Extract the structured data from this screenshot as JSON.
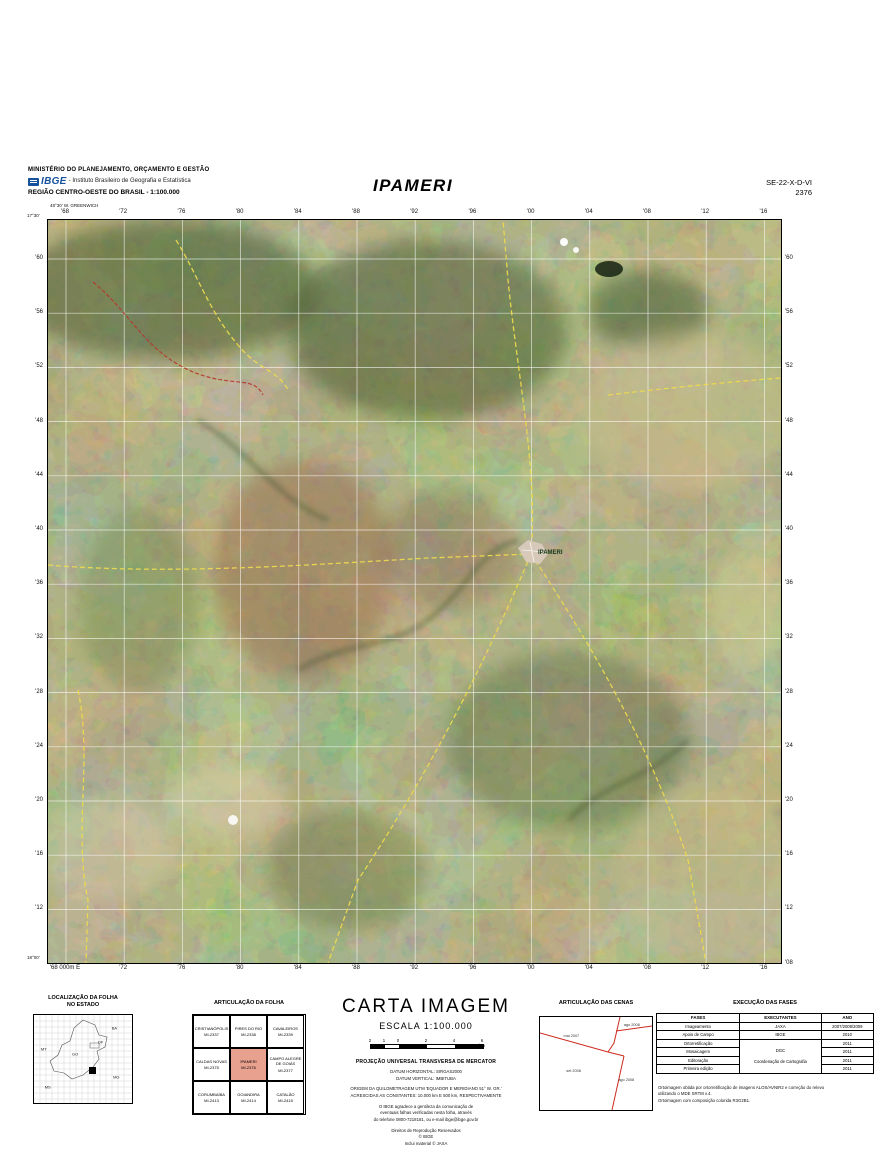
{
  "header": {
    "ministry": "MINISTÉRIO DO PLANEJAMENTO, ORÇAMENTO E GESTÃO",
    "ibge_acronym": "IBGE",
    "ibge_institute": "- Instituto Brasileiro de Geografia e Estatística",
    "region": "REGIÃO CENTRO-OESTE DO BRASIL - 1:100.000",
    "title": "IPAMERI",
    "sheet_code": "SE-22-X-D-VI",
    "sheet_number": "2376"
  },
  "map": {
    "city_label": "IPAMERI",
    "top_labels": [
      "'68",
      "'72",
      "'76",
      "'80",
      "'84",
      "'88",
      "'92",
      "'96",
      "'00",
      "'04",
      "'08",
      "'12",
      "'16"
    ],
    "bottom_labels": [
      "'68 000m E",
      "'72",
      "'76",
      "'80",
      "'84",
      "'88",
      "'92",
      "'96",
      "'00",
      "'04",
      "'08",
      "'12",
      "'16"
    ],
    "left_labels": [
      "'60",
      "'56",
      "'52",
      "'48",
      "'44",
      "'40",
      "'36",
      "'32",
      "'28",
      "'24",
      "'20",
      "'16",
      "'12"
    ],
    "right_labels": [
      "'60",
      "'56",
      "'52",
      "'48",
      "'44",
      "'40",
      "'36",
      "'32",
      "'28",
      "'24",
      "'20",
      "'16",
      "'12",
      "'08"
    ],
    "corners": [
      {
        "text": "48°30' W. GREENWICH",
        "x": 50,
        "y": 203
      },
      {
        "text": "17°30'",
        "x": 27,
        "y": 213
      },
      {
        "text": "18°00'",
        "x": 27,
        "y": 955
      }
    ]
  },
  "localizacao": {
    "title_1": "LOCALIZAÇÃO DA FOLHA",
    "title_2": "NO ESTADO",
    "labels": [
      {
        "t": "MT",
        "x": 10,
        "y": 38
      },
      {
        "t": "BA",
        "x": 82,
        "y": 14
      },
      {
        "t": "GO",
        "x": 42,
        "y": 44
      },
      {
        "t": "DF",
        "x": 68,
        "y": 30
      },
      {
        "t": "MG",
        "x": 84,
        "y": 70
      },
      {
        "t": "MS",
        "x": 14,
        "y": 82
      }
    ]
  },
  "articulacao_folha": {
    "title": "ARTICULAÇÃO DA FOLHA",
    "cells": [
      {
        "name": "CRISTIANÓPOLIS",
        "code": "MI-2337"
      },
      {
        "name": "PIRES DO RIO",
        "code": "MI-2338"
      },
      {
        "name": "CAVALEIROS",
        "code": "MI-2339"
      },
      {
        "name": "CALDAS NOVAS",
        "code": "MI-2375"
      },
      {
        "name": "IPAMERI",
        "code": "MI-2376",
        "highlight": true
      },
      {
        "name": "CAMPO ALEGRE DE GOIÁS",
        "code": "MI-2377"
      },
      {
        "name": "CORUMBAÍBA",
        "code": "MI-2413"
      },
      {
        "name": "GOIANDIRA",
        "code": "MI-2414"
      },
      {
        "name": "CATALÃO",
        "code": "MI-2415"
      }
    ]
  },
  "carta": {
    "title": "CARTA IMAGEM",
    "escala": "ESCALA 1:100.000",
    "scale_ticks": [
      "2",
      "1",
      "0",
      "2",
      "4",
      "6"
    ],
    "scale_unit": "km",
    "projecao": "PROJEÇÃO UNIVERSAL TRANSVERSA DE MERCATOR",
    "datum_lines": [
      "DATUM HORIZONTAL: SIRGAS2000",
      "DATUM VERTICAL: IMBITUBA"
    ],
    "origem_lines": [
      "ORIGEM DA QUILOMETRAGEM UTM 'EQUADOR E MERIDIANO 51° W. GR.'",
      "ACRESCIDAS AS CONSTANTES: 10.000 km E 500 km, RESPECTIVAMENTE"
    ],
    "aviso_lines": [
      "O IBGE agradece a gentileza da comunicação de",
      "eventuais falhas verificadas nesta folha, através",
      "do telefone 0800-7218181, ou e-mail ibge@ibge.gov.br"
    ],
    "direitos_lines": [
      "Direitos de Reprodução Reservados",
      "© IBGE",
      "Inclui material © JAXA"
    ]
  },
  "cenas": {
    "title": "ARTICULAÇÃO DAS CENAS",
    "labels": [
      {
        "text": "mai 2007",
        "x": 28,
        "y": 20
      },
      {
        "text": "ago 2008",
        "x": 82,
        "y": 8
      },
      {
        "text": "set 2008",
        "x": 30,
        "y": 58
      },
      {
        "text": "ago 2008",
        "x": 77,
        "y": 68
      }
    ]
  },
  "fases": {
    "title": "EXECUÇÃO DAS FASES",
    "headers": [
      "FASES",
      "EXECUTANTES",
      "ANO"
    ],
    "rows": [
      {
        "fase": "Imageamento",
        "exec": "JAXA",
        "ano": "2007/2008/2009"
      },
      {
        "fase": "Apoio de Campo",
        "exec": "IBGE",
        "ano": "2010"
      },
      {
        "fase": "Ortorretificação",
        "exec": "DGC",
        "exec2": "Coordenação de Cartografia",
        "exec_rowspan": 4,
        "ano": "2011"
      },
      {
        "fase": "Mosaicagem",
        "ano": "2011"
      },
      {
        "fase": "Editoração",
        "ano": "2011"
      },
      {
        "fase": "Primeira edição",
        "ano": "2011"
      }
    ],
    "notes": [
      "Ortoimagem obtida por ortorretificação de imagens ALOS/AVNIR2 e correção do relevo",
      "utilizando o MDE SRTM v.4.",
      "Ortoimagem com composição colorida R3G2B1."
    ]
  }
}
